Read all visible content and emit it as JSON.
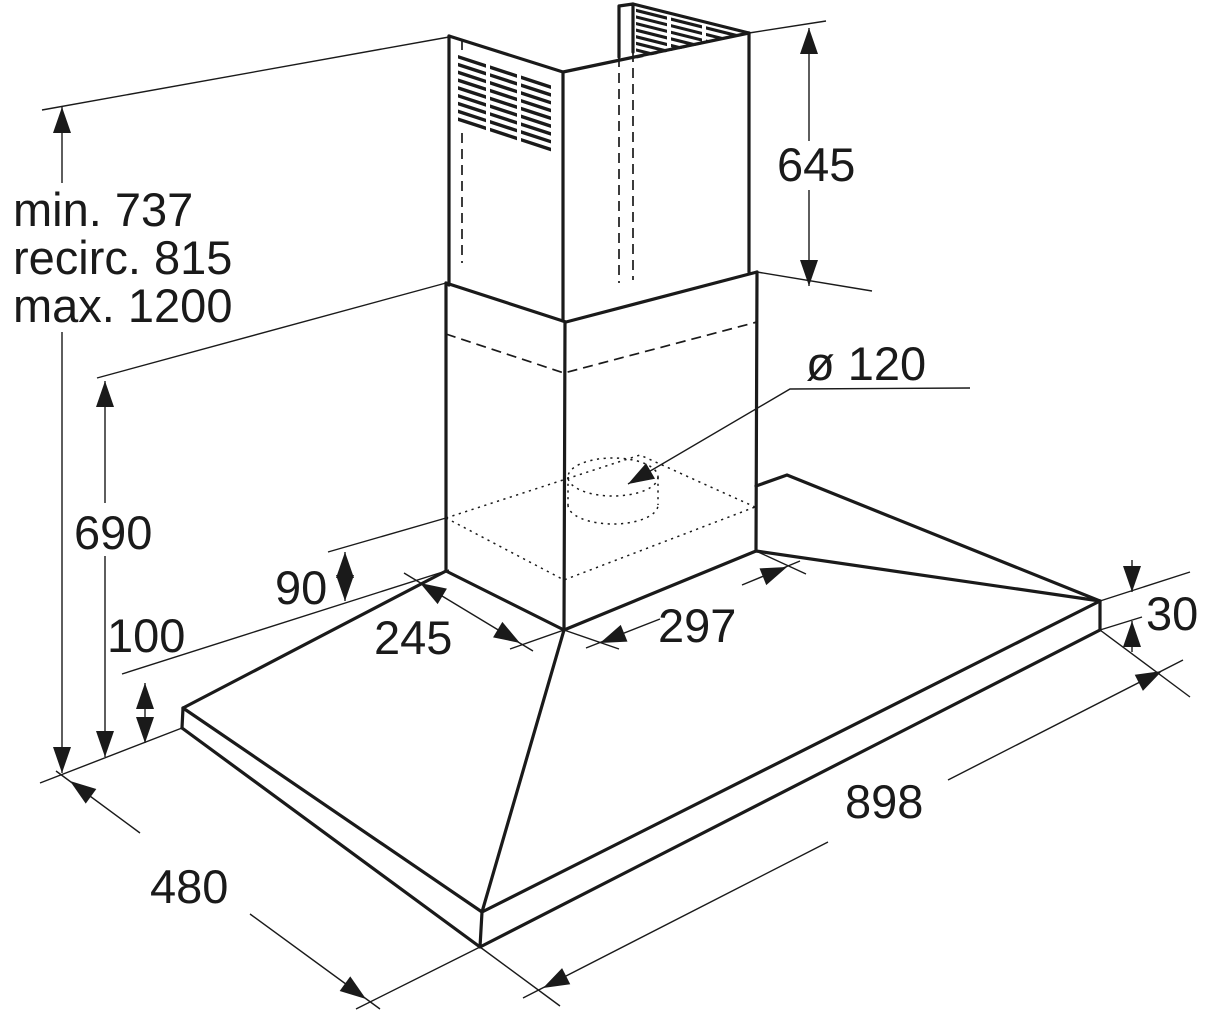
{
  "drawing": {
    "type": "cooker-hood-dimension-diagram",
    "colors": {
      "ink": "#1a1a1a",
      "paper": "#ffffff"
    },
    "labels": {
      "mount_min": "min. 737",
      "mount_recirc": "recirc. 815",
      "mount_max": "max. 1200",
      "chimney_height": "645",
      "duct_diameter": "ø 120",
      "hood_height": "690",
      "rim_height": "90",
      "corner_height": "100",
      "canopy_left_edge": "245",
      "canopy_right_edge": "297",
      "plate_thickness": "30",
      "plate_width": "898",
      "plate_depth": "480"
    }
  }
}
